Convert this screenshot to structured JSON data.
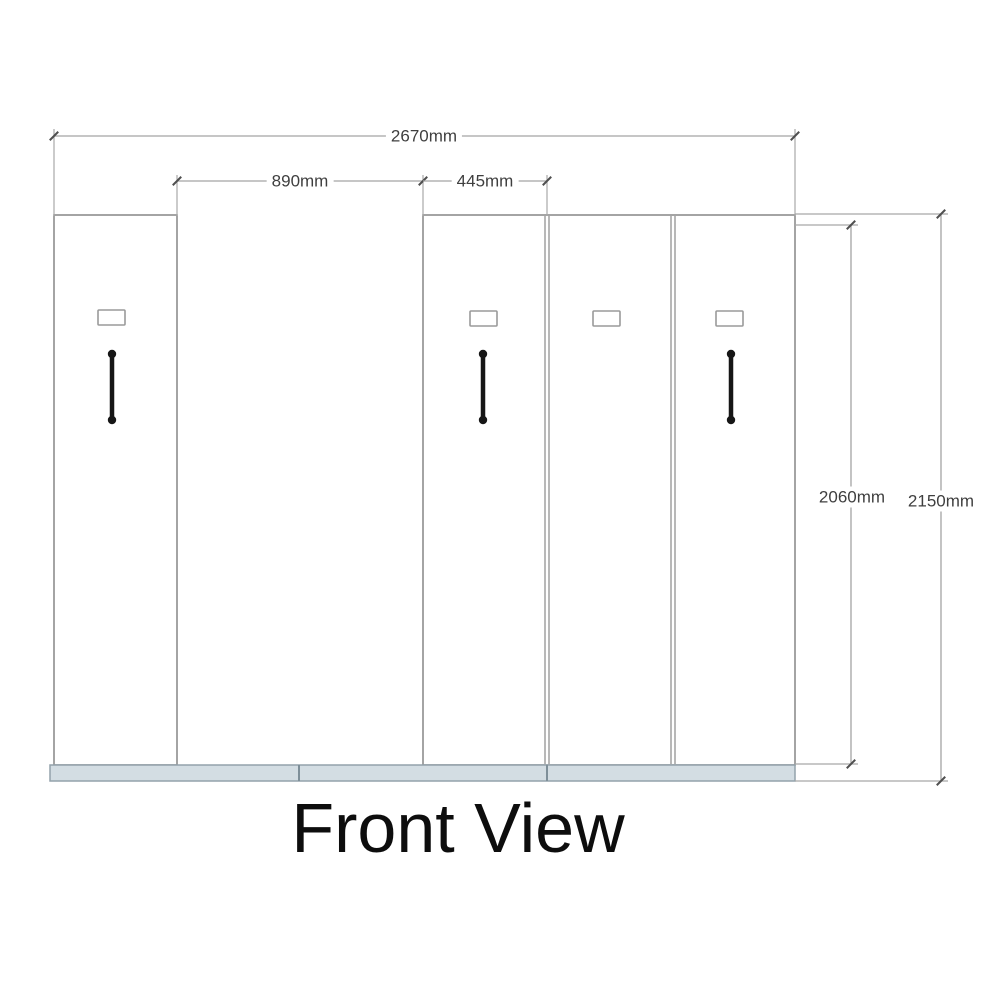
{
  "drawing": {
    "title": "Front View"
  },
  "dimensions": {
    "overall_width": "2670mm",
    "open_bay_width": "890mm",
    "unit_width": "445mm",
    "body_height": "2060mm",
    "overall_height": "2150mm"
  },
  "components": {
    "cabinet_count": 4,
    "handle_count": 3,
    "label_plate_count": 4,
    "plinth_segments": 3
  },
  "colors": {
    "background": "#ffffff",
    "cabinet_outline": "#8d8d8d",
    "dimension_line": "#a3a3a3",
    "tick_mark": "#4f4f4f",
    "dimension_text": "#3f3f3f",
    "title_text": "#0d0d0d",
    "handle": "#161616",
    "plate_outline": "#9a9a9a",
    "plinth_fill": "#d3dde3",
    "plinth_outline": "#93a2ab"
  }
}
